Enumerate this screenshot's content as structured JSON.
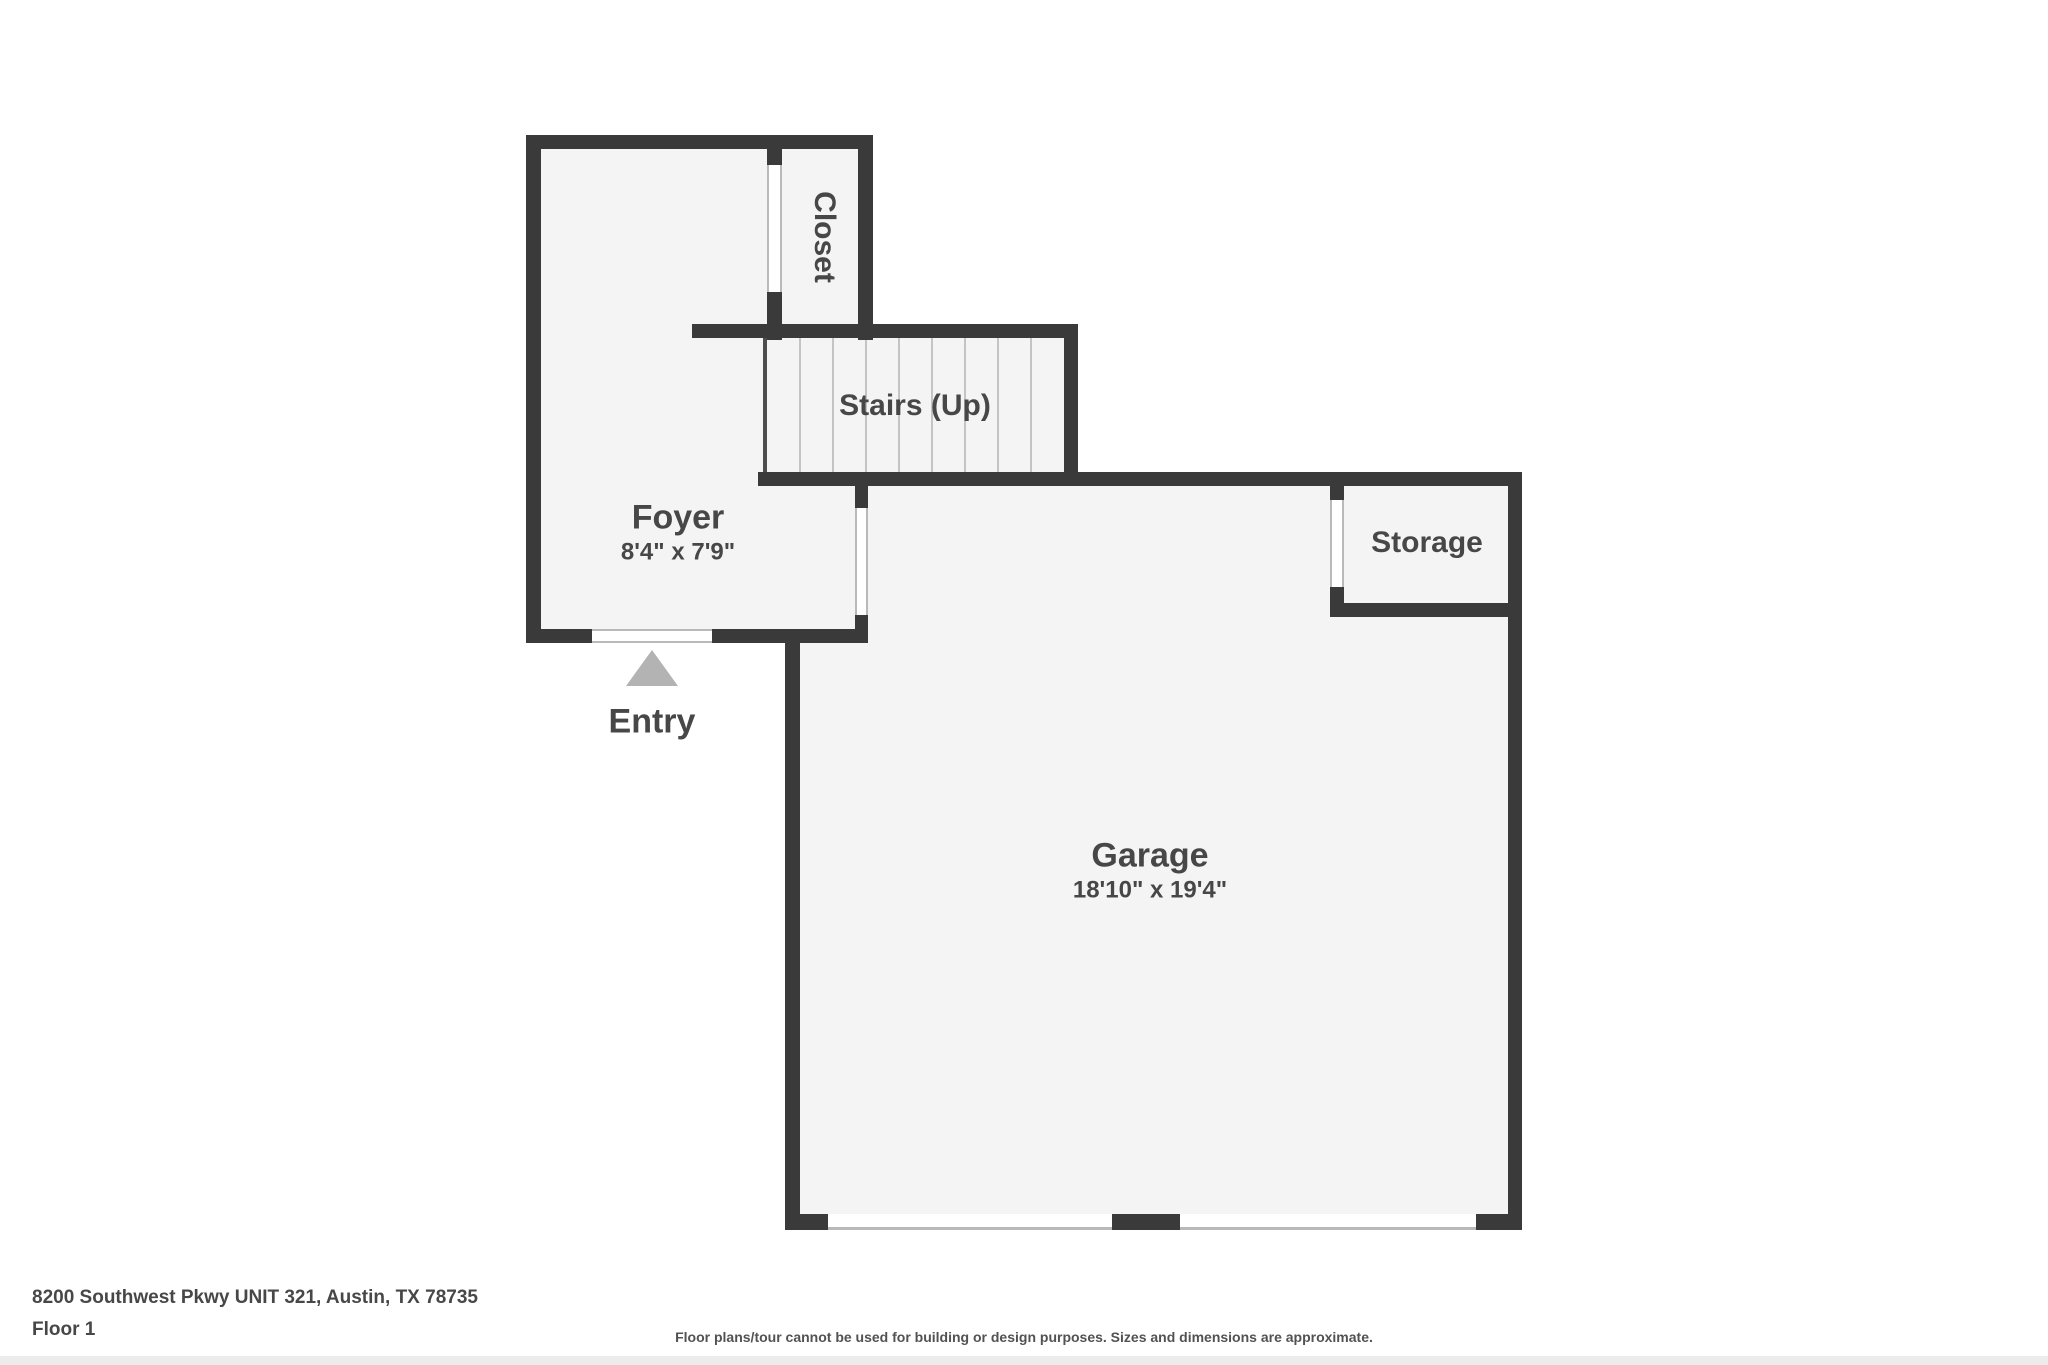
{
  "colors": {
    "wall": "#3a3a3a",
    "room_fill": "#f4f4f4",
    "door_line": "#b9b9b9",
    "tread_line": "#c4c4c4",
    "stairs_edge": "#4d4d4d",
    "label_text": "#474747",
    "entry_arrow": "#b3b3b3",
    "footer_text": "#474747",
    "strip": "#ececec",
    "bg": "#ffffff"
  },
  "rooms": {
    "closet": {
      "label": "Closet"
    },
    "stairs": {
      "label": "Stairs (Up)"
    },
    "foyer": {
      "label": "Foyer",
      "dims": "8'4\" x 7'9\""
    },
    "garage": {
      "label": "Garage",
      "dims": "18'10\" x 19'4\""
    },
    "storage": {
      "label": "Storage"
    },
    "entry": {
      "label": "Entry"
    }
  },
  "footer": {
    "address": "8200 Southwest Pkwy UNIT 321, Austin, TX 78735",
    "floor_label": "Floor 1",
    "disclaimer": "Floor plans/tour cannot be used for building or design purposes. Sizes and dimensions are approximate."
  }
}
